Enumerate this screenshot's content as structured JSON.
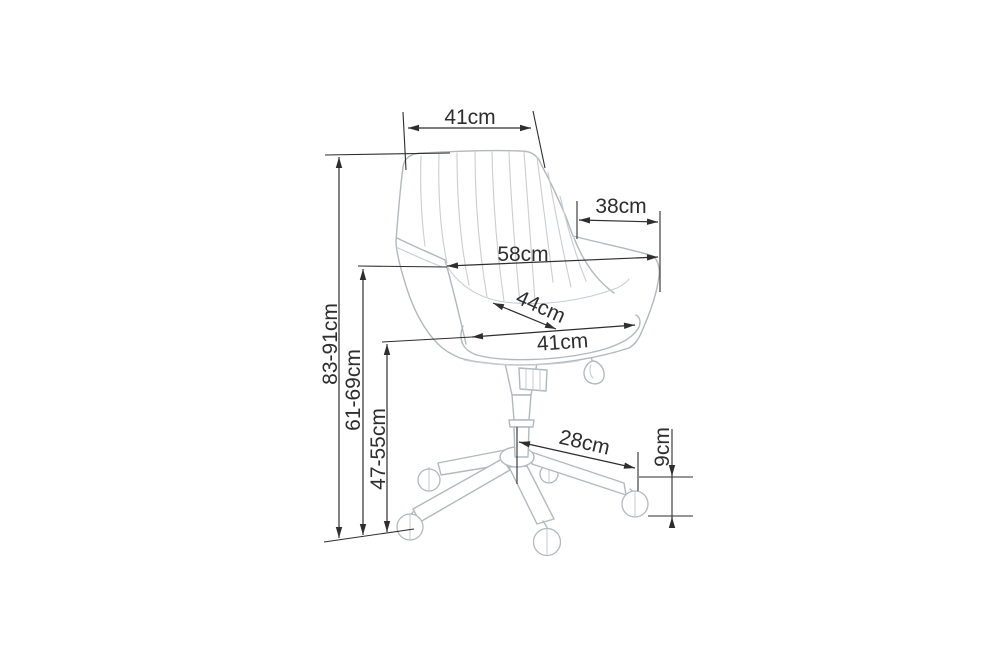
{
  "diagram": {
    "unit": "cm",
    "labels": {
      "backrest_top_width": "41cm",
      "armrest_depth": "38cm",
      "overall_width": "58cm",
      "seat_depth": "44cm",
      "seat_width": "41cm",
      "overall_height": "83-91cm",
      "armrest_height": "61-69cm",
      "seat_height": "47-55cm",
      "base_arm_reach": "28cm",
      "caster_height": "9cm"
    },
    "colors": {
      "dimension": "#2e2e2e",
      "chair_outline": "#b2b9bd",
      "chair_inner": "#c9ced2",
      "background": "#ffffff"
    }
  }
}
